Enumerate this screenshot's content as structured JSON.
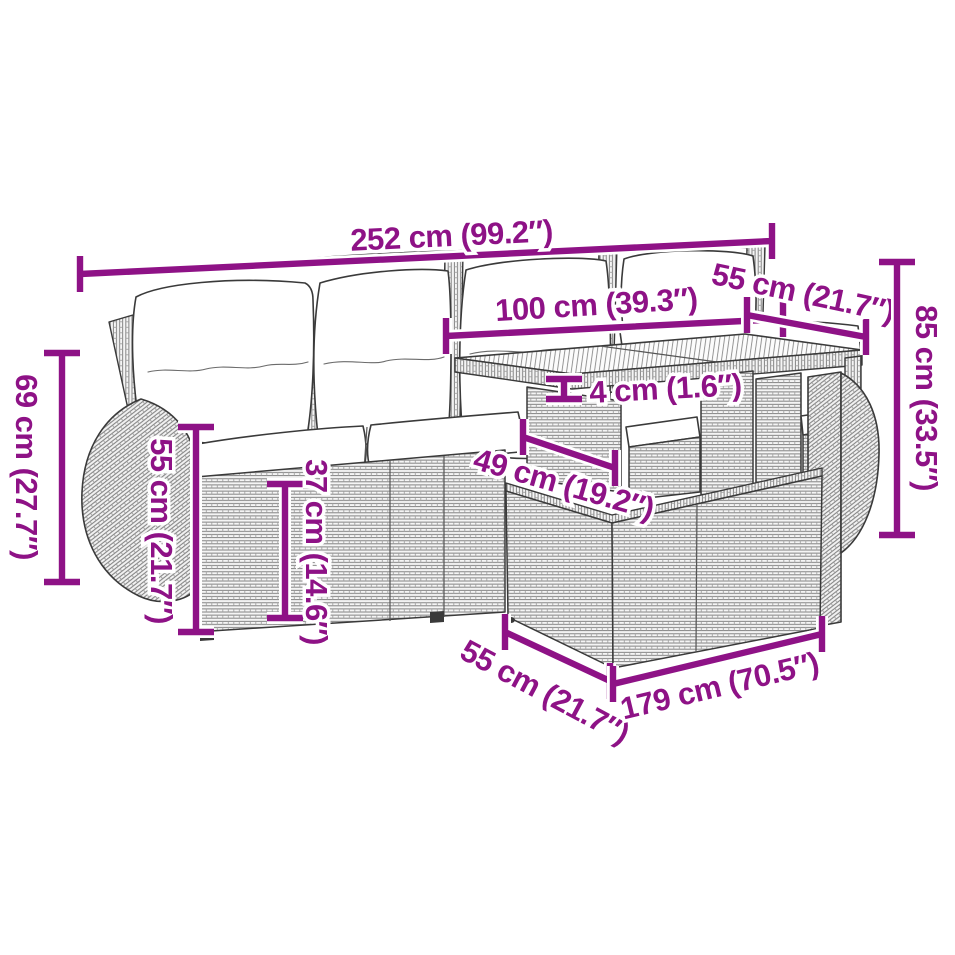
{
  "canvas": {
    "width": 955,
    "height": 955,
    "background": "#ffffff"
  },
  "diagram": {
    "description": "rattan garden sofa set with table and footstool - dimension line drawing",
    "accent_color": "#8E1286",
    "outline_color": "#3a3a3a",
    "dimensions": [
      {
        "id": "overall-width",
        "label": "252 cm (99.2″)"
      },
      {
        "id": "table-width",
        "label": "100 cm (39.3″)"
      },
      {
        "id": "table-depth",
        "label": "55 cm (21.7″)"
      },
      {
        "id": "table-height",
        "label": "85 cm (33.5″)"
      },
      {
        "id": "sofa-height",
        "label": "69 cm (27.7″)"
      },
      {
        "id": "backrest-height",
        "label": "55 cm (21.7″)"
      },
      {
        "id": "seat-height",
        "label": "37 cm (14.6″)"
      },
      {
        "id": "tabletop-thickness",
        "label": "4 cm (1.6″)"
      },
      {
        "id": "under-table-clearance",
        "label": "49 cm (19.2″)"
      },
      {
        "id": "footstool-depth",
        "label": "55 cm (21.7″)"
      },
      {
        "id": "footstool-width",
        "label": "179 cm (70.5″)"
      }
    ]
  }
}
